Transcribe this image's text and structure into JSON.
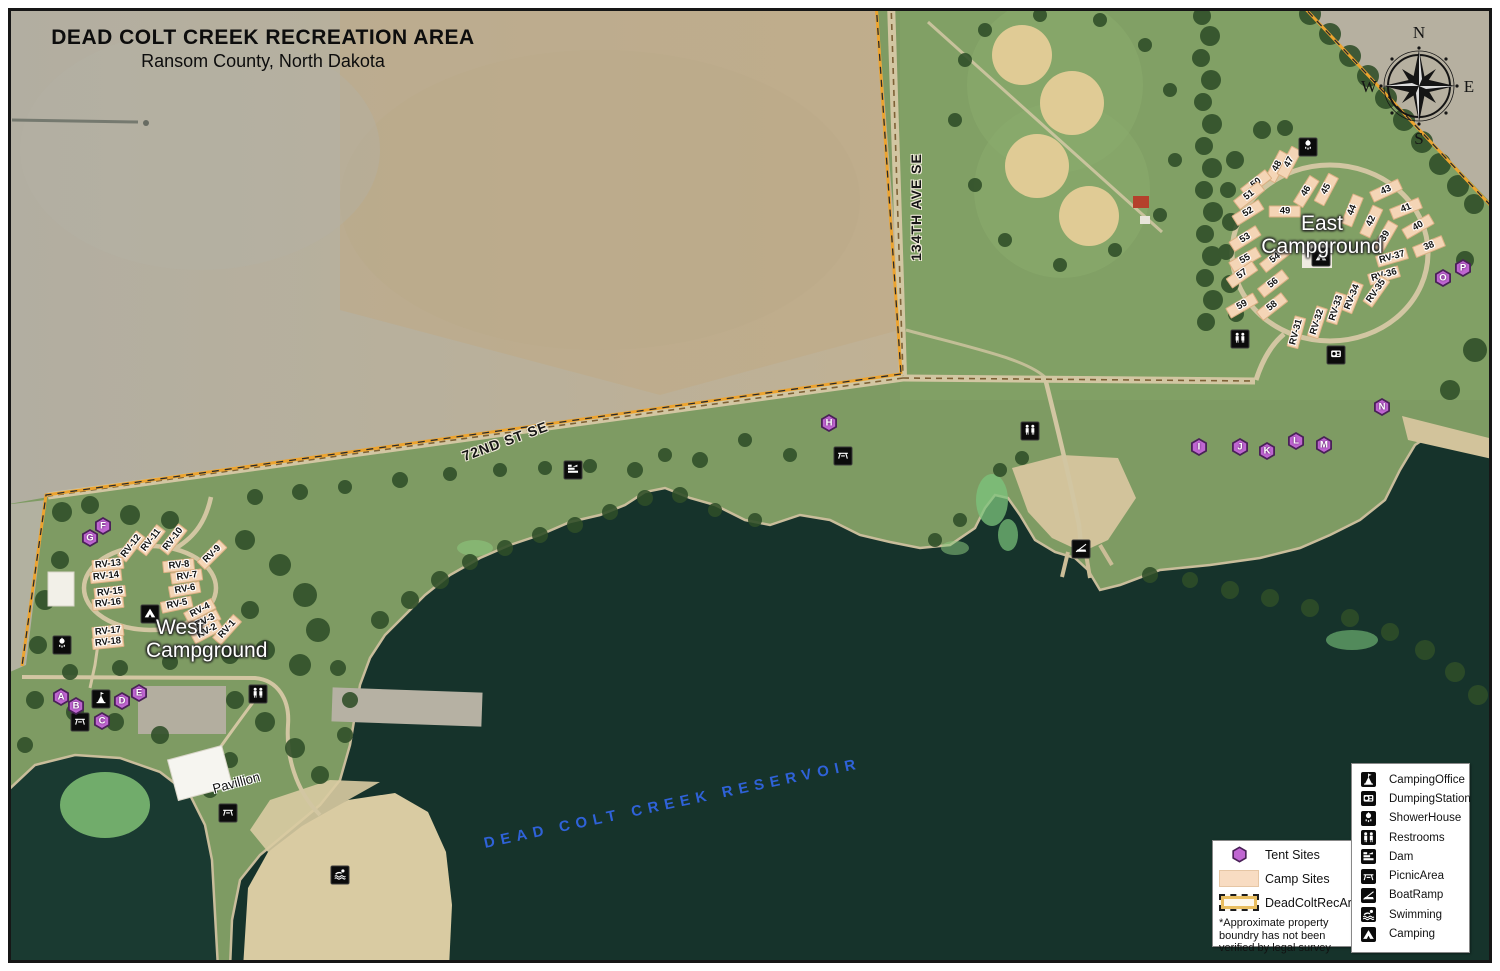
{
  "title": {
    "line1": "DEAD COLT CREEK RECREATION AREA",
    "line2": "Ransom County, North Dakota"
  },
  "compass": {
    "north": "N",
    "east": "E",
    "south": "S",
    "west": "W"
  },
  "road_labels": [
    {
      "text": "134TH AVE SE",
      "x": 916,
      "y": 207,
      "rot": -90
    },
    {
      "text": "72ND ST SE",
      "x": 505,
      "y": 441,
      "rot": -20
    }
  ],
  "water_label": {
    "text": "DEAD COLT CREEK RESERVOIR",
    "x": 480,
    "y": 795,
    "rot": -12
  },
  "campgrounds": {
    "east": {
      "line1": "East",
      "line2": "Campground",
      "x": 1322,
      "y": 213
    },
    "west": {
      "line1": "West",
      "line2": "Campground",
      "x": 146,
      "y": 617
    }
  },
  "pavilion_label": {
    "text": "Pavillion",
    "x": 212,
    "y": 775,
    "rot": -15
  },
  "tent_markers": [
    {
      "letter": "A",
      "x": 61,
      "y": 697
    },
    {
      "letter": "B",
      "x": 76,
      "y": 706
    },
    {
      "letter": "C",
      "x": 102,
      "y": 721
    },
    {
      "letter": "D",
      "x": 122,
      "y": 701
    },
    {
      "letter": "E",
      "x": 139,
      "y": 693
    },
    {
      "letter": "F",
      "x": 103,
      "y": 526
    },
    {
      "letter": "G",
      "x": 90,
      "y": 538
    },
    {
      "letter": "H",
      "x": 829,
      "y": 423
    },
    {
      "letter": "I",
      "x": 1199,
      "y": 447
    },
    {
      "letter": "J",
      "x": 1240,
      "y": 447
    },
    {
      "letter": "K",
      "x": 1267,
      "y": 451
    },
    {
      "letter": "L",
      "x": 1296,
      "y": 441
    },
    {
      "letter": "M",
      "x": 1324,
      "y": 445
    },
    {
      "letter": "N",
      "x": 1382,
      "y": 407
    },
    {
      "letter": "O",
      "x": 1443,
      "y": 278
    },
    {
      "letter": "P",
      "x": 1463,
      "y": 268
    }
  ],
  "east_sites": [
    {
      "label": "48",
      "x": 1277,
      "y": 166,
      "rot": -62
    },
    {
      "label": "47",
      "x": 1289,
      "y": 162,
      "rot": -62
    },
    {
      "label": "50",
      "x": 1256,
      "y": 183,
      "rot": -38
    },
    {
      "label": "51",
      "x": 1249,
      "y": 195,
      "rot": -38
    },
    {
      "label": "52",
      "x": 1248,
      "y": 212,
      "rot": -32
    },
    {
      "label": "49",
      "x": 1285,
      "y": 211,
      "rot": 0
    },
    {
      "label": "46",
      "x": 1306,
      "y": 191,
      "rot": -58
    },
    {
      "label": "45",
      "x": 1326,
      "y": 189,
      "rot": -62
    },
    {
      "label": "44",
      "x": 1352,
      "y": 210,
      "rot": -68
    },
    {
      "label": "43",
      "x": 1386,
      "y": 190,
      "rot": -25
    },
    {
      "label": "42",
      "x": 1371,
      "y": 221,
      "rot": -65
    },
    {
      "label": "41",
      "x": 1406,
      "y": 208,
      "rot": -22
    },
    {
      "label": "40",
      "x": 1418,
      "y": 226,
      "rot": -30
    },
    {
      "label": "39",
      "x": 1385,
      "y": 236,
      "rot": -60
    },
    {
      "label": "38",
      "x": 1429,
      "y": 246,
      "rot": -22
    },
    {
      "label": "53",
      "x": 1245,
      "y": 238,
      "rot": -32
    },
    {
      "label": "55",
      "x": 1245,
      "y": 259,
      "rot": -30
    },
    {
      "label": "54",
      "x": 1275,
      "y": 258,
      "rot": -38
    },
    {
      "label": "57",
      "x": 1242,
      "y": 274,
      "rot": -35
    },
    {
      "label": "56",
      "x": 1273,
      "y": 283,
      "rot": -38
    },
    {
      "label": "59",
      "x": 1242,
      "y": 305,
      "rot": -30
    },
    {
      "label": "58",
      "x": 1272,
      "y": 306,
      "rot": -38
    },
    {
      "label": "RV-37",
      "x": 1392,
      "y": 257,
      "rot": -16
    },
    {
      "label": "RV-36",
      "x": 1384,
      "y": 275,
      "rot": -16
    },
    {
      "label": "RV-35",
      "x": 1376,
      "y": 291,
      "rot": -55
    },
    {
      "label": "RV-34",
      "x": 1352,
      "y": 297,
      "rot": -68
    },
    {
      "label": "RV-33",
      "x": 1336,
      "y": 308,
      "rot": -72
    },
    {
      "label": "RV-32",
      "x": 1317,
      "y": 322,
      "rot": -72
    },
    {
      "label": "RV-31",
      "x": 1296,
      "y": 332,
      "rot": -75
    }
  ],
  "west_sites": [
    {
      "label": "RV-12",
      "x": 131,
      "y": 546,
      "rot": -52
    },
    {
      "label": "RV-11",
      "x": 151,
      "y": 540,
      "rot": -52
    },
    {
      "label": "RV-10",
      "x": 173,
      "y": 539,
      "rot": -52
    },
    {
      "label": "RV-9",
      "x": 212,
      "y": 554,
      "rot": -45
    },
    {
      "label": "RV-13",
      "x": 108,
      "y": 564,
      "rot": -6
    },
    {
      "label": "RV-14",
      "x": 106,
      "y": 576,
      "rot": -6
    },
    {
      "label": "RV-15",
      "x": 110,
      "y": 592,
      "rot": -6
    },
    {
      "label": "RV-16",
      "x": 108,
      "y": 603,
      "rot": -6
    },
    {
      "label": "RV-8",
      "x": 179,
      "y": 565,
      "rot": -6
    },
    {
      "label": "RV-7",
      "x": 187,
      "y": 576,
      "rot": -8
    },
    {
      "label": "RV-6",
      "x": 185,
      "y": 589,
      "rot": -10
    },
    {
      "label": "RV-5",
      "x": 177,
      "y": 604,
      "rot": -12
    },
    {
      "label": "RV-4",
      "x": 200,
      "y": 610,
      "rot": -28
    },
    {
      "label": "RV-3",
      "x": 205,
      "y": 621,
      "rot": -28
    },
    {
      "label": "RV-2",
      "x": 207,
      "y": 631,
      "rot": -28
    },
    {
      "label": "RV-1",
      "x": 227,
      "y": 629,
      "rot": -48
    },
    {
      "label": "RV-17",
      "x": 108,
      "y": 631,
      "rot": -6
    },
    {
      "label": "RV-18",
      "x": 108,
      "y": 642,
      "rot": -6
    }
  ],
  "map_icons": [
    {
      "type": "shower-house",
      "x": 1308,
      "y": 147
    },
    {
      "type": "restrooms",
      "x": 1240,
      "y": 339
    },
    {
      "type": "dumping-station",
      "x": 1336,
      "y": 355
    },
    {
      "type": "camping",
      "x": 1321,
      "y": 257
    },
    {
      "type": "restrooms",
      "x": 1030,
      "y": 431
    },
    {
      "type": "picnic-area",
      "x": 843,
      "y": 456
    },
    {
      "type": "dam",
      "x": 573,
      "y": 470
    },
    {
      "type": "boat-ramp",
      "x": 1081,
      "y": 549
    },
    {
      "type": "shower-house",
      "x": 62,
      "y": 645
    },
    {
      "type": "camping",
      "x": 150,
      "y": 614
    },
    {
      "type": "camping-office",
      "x": 101,
      "y": 699
    },
    {
      "type": "picnic-area",
      "x": 80,
      "y": 722
    },
    {
      "type": "restrooms",
      "x": 258,
      "y": 694
    },
    {
      "type": "picnic-area",
      "x": 228,
      "y": 813
    },
    {
      "type": "swimming",
      "x": 340,
      "y": 875
    }
  ],
  "legend_icons": {
    "items": [
      {
        "icon": "camping-office",
        "label": "CampingOffice"
      },
      {
        "icon": "dumping-station",
        "label": "DumpingStation"
      },
      {
        "icon": "shower-house",
        "label": "ShowerHouse"
      },
      {
        "icon": "restrooms",
        "label": "Restrooms"
      },
      {
        "icon": "dam",
        "label": "Dam"
      },
      {
        "icon": "picnic-area",
        "label": "PicnicArea"
      },
      {
        "icon": "boat-ramp",
        "label": "BoatRamp"
      },
      {
        "icon": "swimming",
        "label": "Swimming"
      },
      {
        "icon": "camping",
        "label": "Camping"
      }
    ]
  },
  "legend_sites": {
    "items": [
      {
        "swatch": "hex",
        "label": "Tent Sites"
      },
      {
        "swatch": "camp",
        "label": "Camp Sites"
      },
      {
        "swatch": "boundary",
        "label": "DeadColtRecArea*"
      }
    ],
    "note": "*Approximate property\nboundry has not been\nverified by legal survey"
  },
  "colors": {
    "boundary": "#eda42f",
    "tent_marker": "#c066d2",
    "camp_site": "#f4d5b6",
    "water": "#16332b",
    "water_label": "#2f62d8"
  }
}
